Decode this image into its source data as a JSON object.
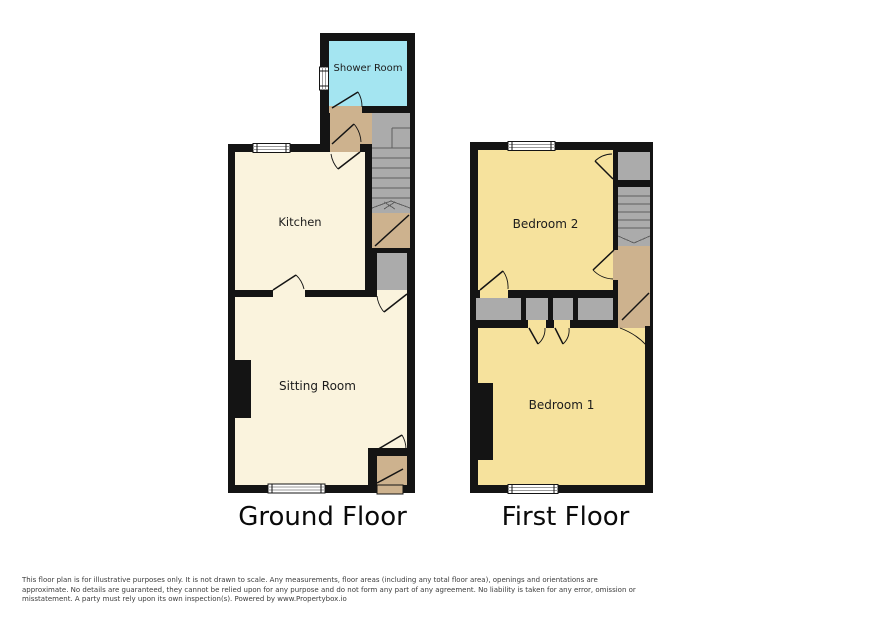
{
  "floors": [
    {
      "title": "Ground Floor",
      "rooms": [
        {
          "label": "Shower Room"
        },
        {
          "label": "Kitchen"
        },
        {
          "label": "Sitting Room"
        }
      ]
    },
    {
      "title": "First Floor",
      "rooms": [
        {
          "label": "Bedroom 2"
        },
        {
          "label": "Bedroom 1"
        }
      ]
    }
  ],
  "colors": {
    "wall": "#141414",
    "shower_floor": "#a4e5f1",
    "ground_floor_rooms": "#faf3dd",
    "bedroom_floor": "#f6e29d",
    "hall_floor": "#cdb28e",
    "stairs": "#ababab",
    "window": "#ffffff"
  },
  "disclaimer": {
    "lines": [
      "This floor plan is for illustrative purposes only. It is not drawn to scale. Any measurements, floor areas (including any total floor area), openings and orientations are",
      "approximate. No details are guaranteed, they cannot be relied upon for any purpose and do not form any part of any agreement. No liability is taken for any error, omission or",
      "misstatement. A party must rely upon its own inspection(s). Powered by www.Propertybox.io"
    ]
  }
}
